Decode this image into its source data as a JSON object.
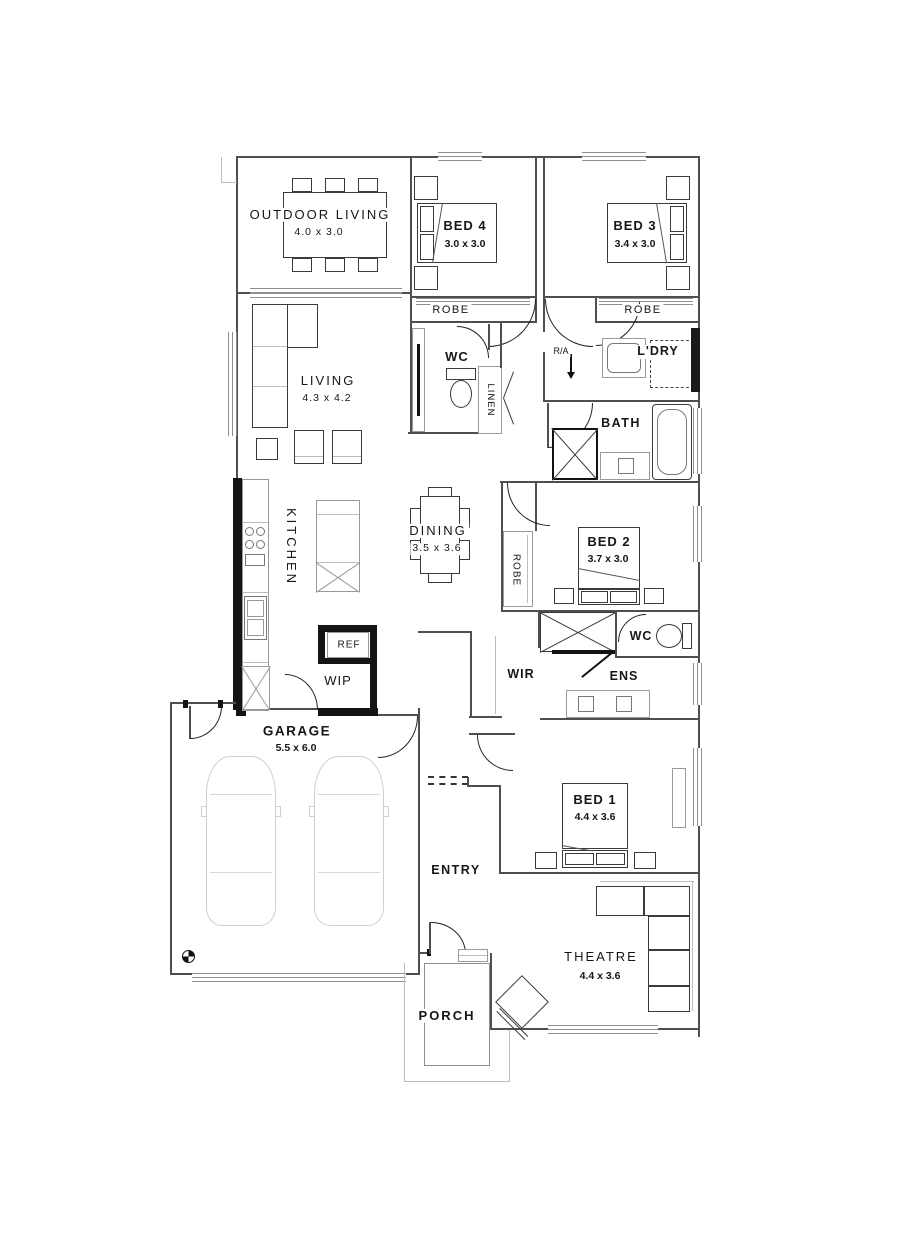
{
  "title": "single-storey house floor plan",
  "colors": {
    "wall": "#4f4f4f",
    "feature_wall": "#141414",
    "furniture": "#9a9a9a",
    "furniture_light": "#cfcfcf",
    "label": "#161616",
    "window": "#8f8f8f",
    "background": "#ffffff"
  },
  "rooms": [
    {
      "id": "outdoor-living",
      "label": "OUTDOOR LIVING",
      "dims": "4.0 x 3.0"
    },
    {
      "id": "bed4",
      "label": "BED 4",
      "dims": "3.0 x 3.0"
    },
    {
      "id": "bed3",
      "label": "BED 3",
      "dims": "3.4 x 3.0"
    },
    {
      "id": "robe-bed4",
      "label": "ROBE"
    },
    {
      "id": "robe-bed3",
      "label": "ROBE"
    },
    {
      "id": "wc-hall",
      "label": "WC"
    },
    {
      "id": "linen",
      "label": "LINEN"
    },
    {
      "id": "return-air",
      "label": "R/A"
    },
    {
      "id": "laundry",
      "label": "L'DRY"
    },
    {
      "id": "bath",
      "label": "BATH"
    },
    {
      "id": "living",
      "label": "LIVING",
      "dims": "4.3 x 4.2"
    },
    {
      "id": "kitchen",
      "label": "KITCHEN"
    },
    {
      "id": "dining",
      "label": "DINING",
      "dims": "3.5 x 3.6"
    },
    {
      "id": "robe-bed2",
      "label": "ROBE"
    },
    {
      "id": "bed2",
      "label": "BED 2",
      "dims": "3.7 x 3.0"
    },
    {
      "id": "wc-ens",
      "label": "WC"
    },
    {
      "id": "wir",
      "label": "WIR"
    },
    {
      "id": "ens",
      "label": "ENS"
    },
    {
      "id": "fridge",
      "label": "REF"
    },
    {
      "id": "wip",
      "label": "WIP"
    },
    {
      "id": "garage",
      "label": "GARAGE",
      "dims": "5.5 x 6.0"
    },
    {
      "id": "entry",
      "label": "ENTRY"
    },
    {
      "id": "bed1",
      "label": "BED 1",
      "dims": "4.4 x 3.6"
    },
    {
      "id": "theatre",
      "label": "THEATRE",
      "dims": "4.4 x 3.6"
    },
    {
      "id": "porch",
      "label": "PORCH"
    }
  ]
}
